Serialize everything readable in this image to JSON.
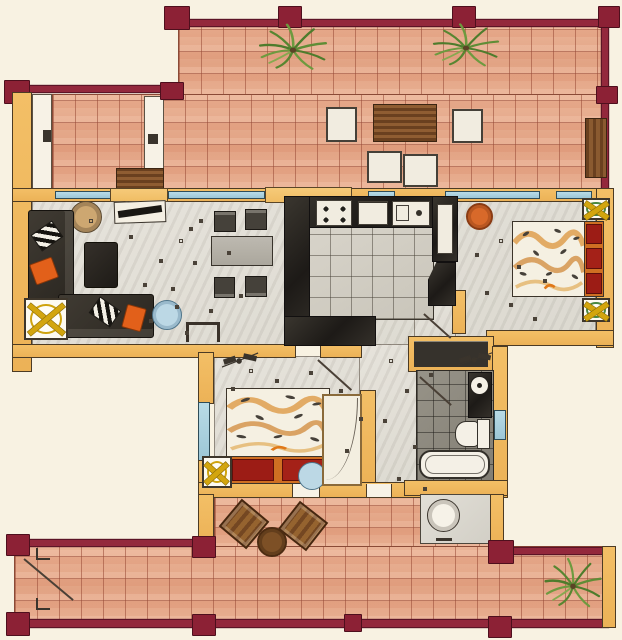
{
  "document": {
    "kind": "hand-drawn apartment floor plan",
    "visible_text": []
  },
  "palette": {
    "paper": "#f8f2e2",
    "terrace_tile": "#e7ad8f",
    "tile_grid": "#9c5d45",
    "railing_maroon": "#8f2538",
    "wall_tan": "#f0ba60",
    "window_blue": "#abd2df",
    "interior_floor": "#e1ded6",
    "kitchen_counter": "#2b2824",
    "bath_floor": "#8e8a80",
    "sofa_charcoal": "#3a352f",
    "accent_orange": "#d8692a",
    "pillow_red": "#9c1c15",
    "table_yellow": "#d3a50e",
    "plant_green": "#578631",
    "wood_brown": "#8a5a30"
  },
  "rooms": [
    {
      "name": "upper-terrace",
      "features": [
        "tiled-floor",
        "maroon-railing-with-posts",
        "two-palm-plants",
        "slatted-lounge-table",
        "four-white-cushion-seats",
        "wood-bench",
        "planter-box"
      ]
    },
    {
      "name": "living-room",
      "features": [
        "corner-sofa",
        "striped-cushions",
        "orange-cushions",
        "coffee-table",
        "round-side-table",
        "tv-sideboard",
        "yellow-x-side-table",
        "round-blue-table",
        "wall-console"
      ]
    },
    {
      "name": "dining-area",
      "features": [
        "rectangular-table",
        "four-chairs"
      ]
    },
    {
      "name": "kitchen",
      "features": [
        "u-shaped-dark-counter",
        "stove-four-burners",
        "sink",
        "drawer-unit",
        "tall-cabinet",
        "tiled-floor"
      ]
    },
    {
      "name": "bedroom-east",
      "features": [
        "double-bed-patterned-duvet",
        "red-pillows",
        "two-x-nightstands",
        "orange-stool",
        "window"
      ]
    },
    {
      "name": "bedroom-south",
      "features": [
        "double-bed-patterned-duvet",
        "red-pillows",
        "x-nightstand",
        "blue-stool",
        "wardrobe",
        "ceiling-fan-sketch",
        "window"
      ]
    },
    {
      "name": "bathroom",
      "features": [
        "bathtub",
        "toilet",
        "washbasin-counter",
        "window",
        "dark-tiled-floor",
        "storage-closet"
      ]
    },
    {
      "name": "utility-room",
      "features": [
        "washing-machine"
      ]
    },
    {
      "name": "hallway",
      "features": [
        "door-swings",
        "ceiling-lamp-sketch"
      ]
    },
    {
      "name": "lower-terrace",
      "features": [
        "tiled-floor",
        "maroon-railing-with-posts",
        "two-wood-chairs",
        "round-wood-table",
        "plant",
        "stair-mark"
      ]
    }
  ]
}
